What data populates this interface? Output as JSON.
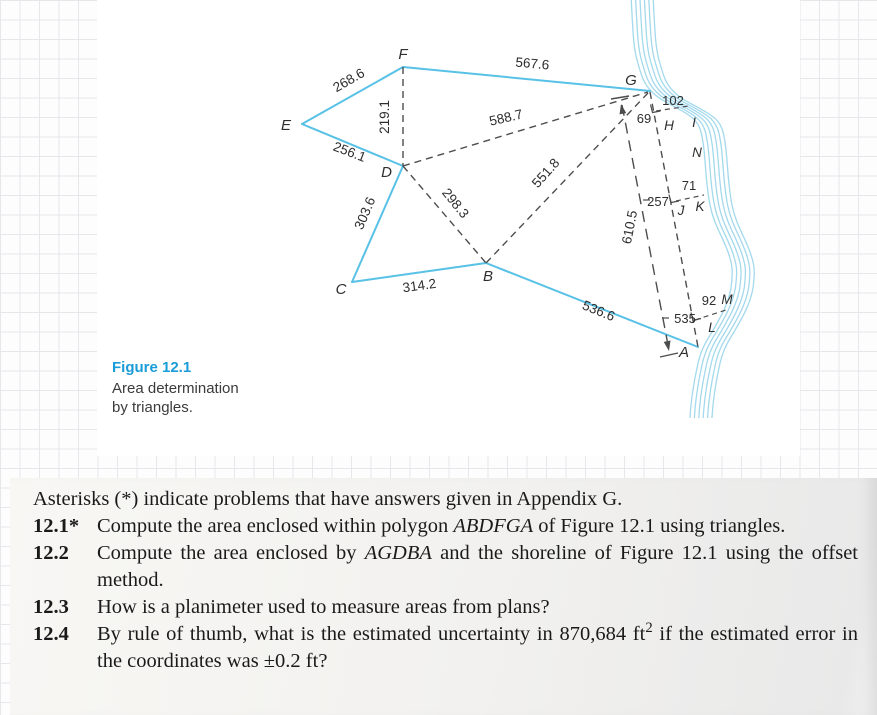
{
  "figure_page": {
    "caption": {
      "label": "Figure 12.1",
      "lines": [
        "Area determination",
        "by triangles."
      ]
    },
    "diagram": {
      "colors": {
        "survey_line": "#58c1e6",
        "shoreline": "#a3d9ec",
        "dashed_line": "#4d4d4d",
        "caption_accent": "#1a9cd8"
      },
      "vertices": {
        "A": "A",
        "B": "B",
        "C": "C",
        "D": "D",
        "E": "E",
        "F": "F",
        "G": "G"
      },
      "shore_points": {
        "H": "H",
        "I": "I",
        "J": "J",
        "K": "K",
        "L": "L",
        "M": "M",
        "N": "N"
      },
      "distances": {
        "EF": "268.6",
        "FD": "219.1",
        "ED": "256.1",
        "FG": "567.6",
        "DG": "588.7",
        "BG": "551.8",
        "DB": "298.3",
        "CD": "303.6",
        "CB": "314.2",
        "BA": "536.6",
        "GA": "610.5"
      },
      "offsets": [
        {
          "station": "69",
          "offset": "102"
        },
        {
          "station": "257",
          "offset": "71"
        },
        {
          "station": "535",
          "offset": "92"
        }
      ]
    }
  },
  "problems_page": {
    "intro": "Asterisks (*) indicate problems that have answers given in Appendix G.",
    "items": [
      {
        "num": "12.1*",
        "pre": "Compute the area enclosed within polygon ",
        "em": "ABDFGA",
        "post": " of Figure 12.1 using triangles."
      },
      {
        "num": "12.2",
        "pre": "Compute the area enclosed by ",
        "em": "AGDBA",
        "post": " and the shoreline of Figure 12.1 using the offset method."
      },
      {
        "num": "12.3",
        "pre": "How is a planimeter used to measure areas from plans?",
        "em": "",
        "post": ""
      },
      {
        "num": "12.4",
        "pre": "By rule of thumb, what is the estimated uncertainty in 870,684 ft",
        "sup": "2",
        "post": " if the estimated error in the coordinates was ±0.2 ft?"
      }
    ]
  }
}
